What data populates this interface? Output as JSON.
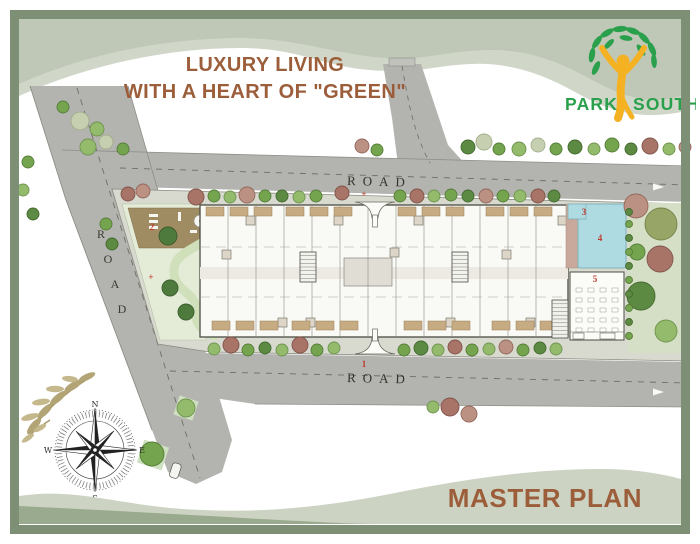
{
  "header": {
    "title_line1": "LUXURY LIVING",
    "title_line2": "WITH A HEART OF \"GREEN\""
  },
  "brand": {
    "left": "PARK",
    "right": "SOUTH"
  },
  "footer": {
    "label": "MASTER PLAN"
  },
  "plan": {
    "road_label_top": "ROAD",
    "road_label_bottom": "ROAD",
    "road_left_letters": [
      "R",
      "O",
      "A",
      "D"
    ],
    "compass": {
      "north": "N",
      "east": "E",
      "south": "S",
      "west": "W"
    },
    "markers": {
      "top_gate": "+",
      "main_gate": "1",
      "deck": "2",
      "lawn": "+",
      "kids_pool": "3",
      "swimming_pool": "4",
      "party_hall": "5"
    }
  },
  "colors": {
    "frame_green": "#7d8f74",
    "title_brown": "#9c5e3a",
    "logo_green": "#2aa04c",
    "logo_yellow": "#f4b223",
    "road_gray": "#b3b3af",
    "pool_blue": "#aedae2",
    "marker_red": "#c03a2b"
  }
}
